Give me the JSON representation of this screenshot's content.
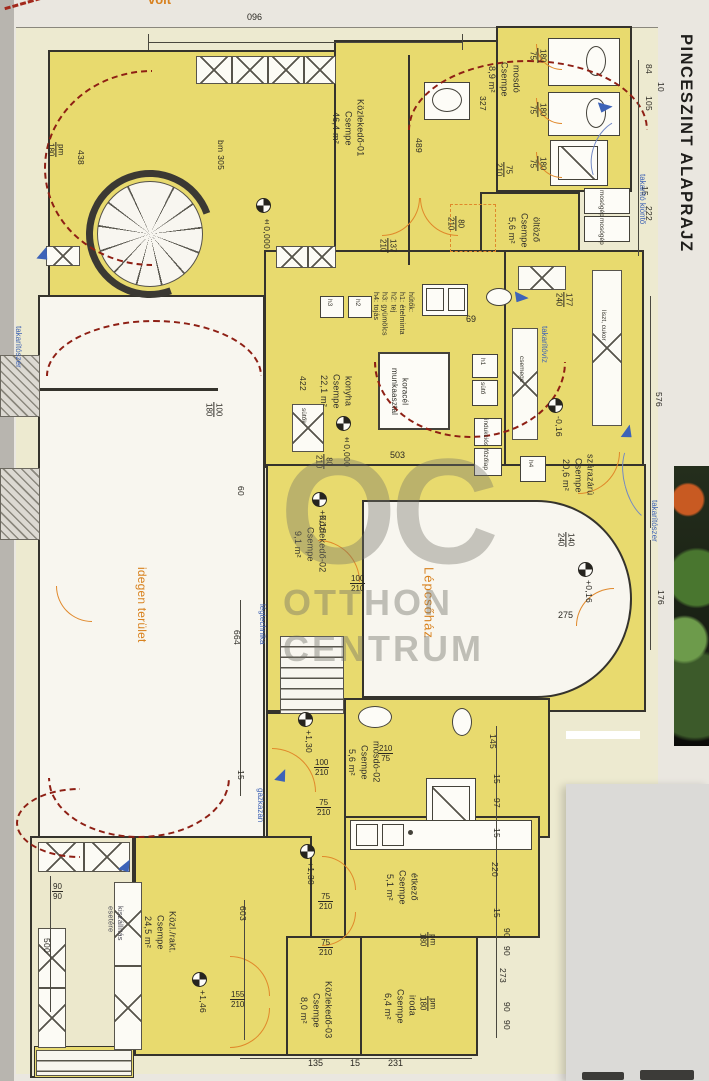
{
  "title": "PINCESZINT ALAPRAJZ",
  "top_note": "volt",
  "watermark": {
    "monogram": "OC",
    "line1": "OTTHON",
    "line2": "CENTRUM"
  },
  "rooms": {
    "kozlekedo01_name": "Közlekedő-01",
    "kozlekedo01_finish": "Csempe",
    "kozlekedo01_area": "46,4 m²",
    "kozlekedo01_height": "bm 305",
    "mosdo01_name": "mosdó",
    "mosdo01_finish": "Csempe",
    "mosdo01_area": "8,9 m²",
    "oltozo_name": "öltöző",
    "oltozo_finish": "Csempe",
    "oltozo_area": "5,6 m²",
    "konyha_name": "konyha",
    "konyha_finish": "Csempe",
    "konyha_area": "22,1 m²",
    "szarazaru_name": "szárazárú",
    "szarazaru_finish": "Csempe",
    "szarazaru_area": "20,6 m²",
    "lepcsohaz_name": "Lépcsőház",
    "kozlekedo02_name": "Közlekedő-02",
    "kozlekedo02_finish": "Csempe",
    "kozlekedo02_area": "9,1 m²",
    "mosdo02_name": "mosdó-02",
    "mosdo02_finish": "Csempe",
    "mosdo02_area": "5,6 m²",
    "etkezo_name": "étkező",
    "etkezo_finish": "Csempe",
    "etkezo_area": "5,1 m²",
    "kozlrakt_name": "Közl./rakt.",
    "kozlrakt_finish": "Csempe",
    "kozlrakt_area": "24,5 m²",
    "kozlekedo03_name": "Közlekedő-03",
    "kozlekedo03_finish": "Csempe",
    "kozlekedo03_area": "8,0 m²",
    "iroda_name": "iroda",
    "iroda_finish": "Csempe",
    "iroda_area": "6,4 m²",
    "idegen_name": "idegen terület"
  },
  "equipment": {
    "worktable1": "koracél",
    "worktable2": "munkaasztal",
    "fridges_title": "hűtők:",
    "fridge1": "h1: ételminta",
    "fridge2": "h2: tej",
    "fridge3": "h3: gyümölcs",
    "fridge4": "h4: tojás",
    "box_h1": "h1",
    "box_h2": "h2",
    "box_h3": "h3",
    "box_h4": "h4",
    "box_suto": "sütő",
    "box_sutok": "sütők",
    "box_indukcios": "indukciós",
    "box_fozolap": "főzőlap",
    "shelf_csemege": "csemege",
    "shelf_liszt_cukor": "liszt, cukor",
    "mosogep": "mosógép"
  },
  "notes": {
    "takarito_kionto": "takarító kiöntő",
    "takaritoviz": "takarítóvíz",
    "takaritoszer": "takarítószer",
    "legtechnika": "légtechnika",
    "gazkazan": "gázkazán",
    "kiszallitas1": "kiszállítás",
    "kiszallitas2": "esetére"
  },
  "levels": {
    "zero": "±0,000",
    "m016": "-0,16",
    "p016": "+0,16",
    "p130": "+1,30",
    "p146": "+1,46"
  },
  "dims": {
    "n096": "096",
    "n84": "84",
    "n10": "10",
    "n105": "105",
    "n15": "15",
    "n222": "222",
    "n438": "438",
    "pm": "pm",
    "n180": "180",
    "n489": "489",
    "n327": "327",
    "n75": "75",
    "n210": "210",
    "n137": "137",
    "n80": "80",
    "n177": "177",
    "n240": "240",
    "n140": "140",
    "n100": "100",
    "n155": "155",
    "n69": "69",
    "n503": "503",
    "n422": "422",
    "n60": "60",
    "n664": "664",
    "n576": "576",
    "n176": "176",
    "n275": "275",
    "n145": "145",
    "n97": "97",
    "n220": "220",
    "n90": "90",
    "n273": "273",
    "n500": "500",
    "n603": "603",
    "n135": "135",
    "n231": "231"
  }
}
